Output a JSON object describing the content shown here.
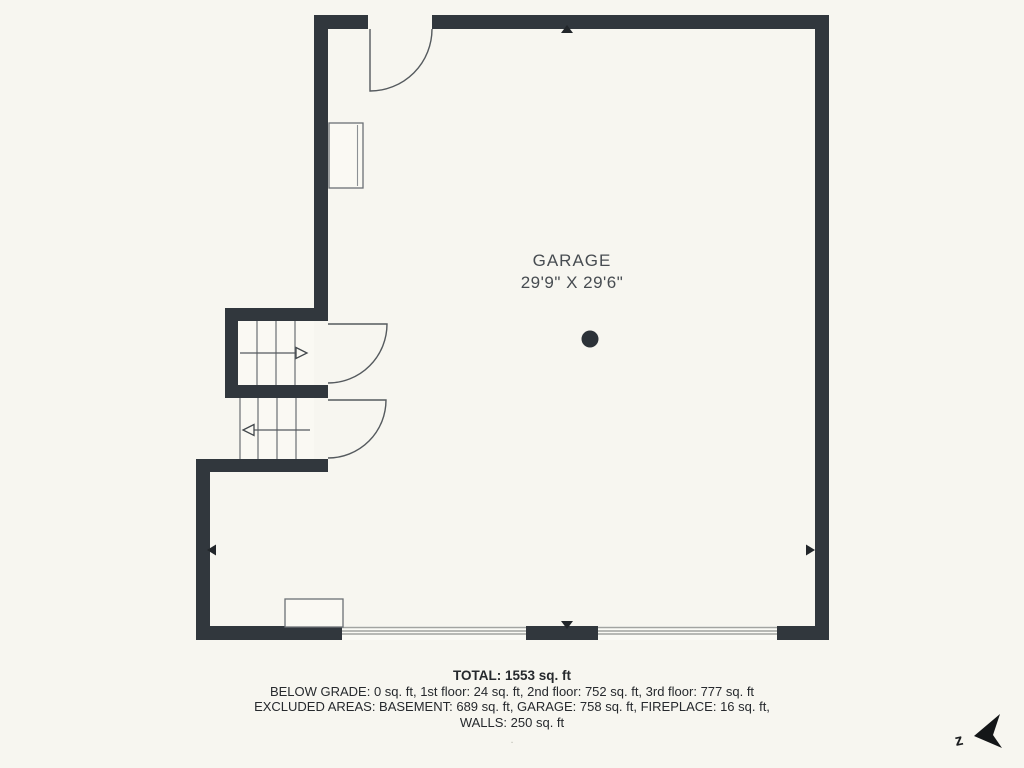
{
  "room": {
    "name": "GARAGE",
    "dimensions": "29'9\" X 29'6\""
  },
  "summary": {
    "total": "TOTAL: 1553 sq. ft",
    "lines": [
      "BELOW GRADE: 0 sq. ft, 1st floor: 24 sq. ft, 2nd floor: 752 sq. ft, 3rd floor: 777 sq. ft",
      "EXCLUDED AREAS: BASEMENT: 689 sq. ft, GARAGE: 758 sq. ft, FIREPLACE: 16 sq. ft,",
      "WALLS: 250 sq. ft"
    ],
    "footnote": "."
  },
  "compass": {
    "label": "z"
  },
  "colors": {
    "background": "#f7f6f0",
    "wall": "#31373d",
    "thin_line": "#555a5e",
    "garage_door_line": "#a2a4a1",
    "label_text": "#474c51",
    "footer_text": "#26292d"
  }
}
